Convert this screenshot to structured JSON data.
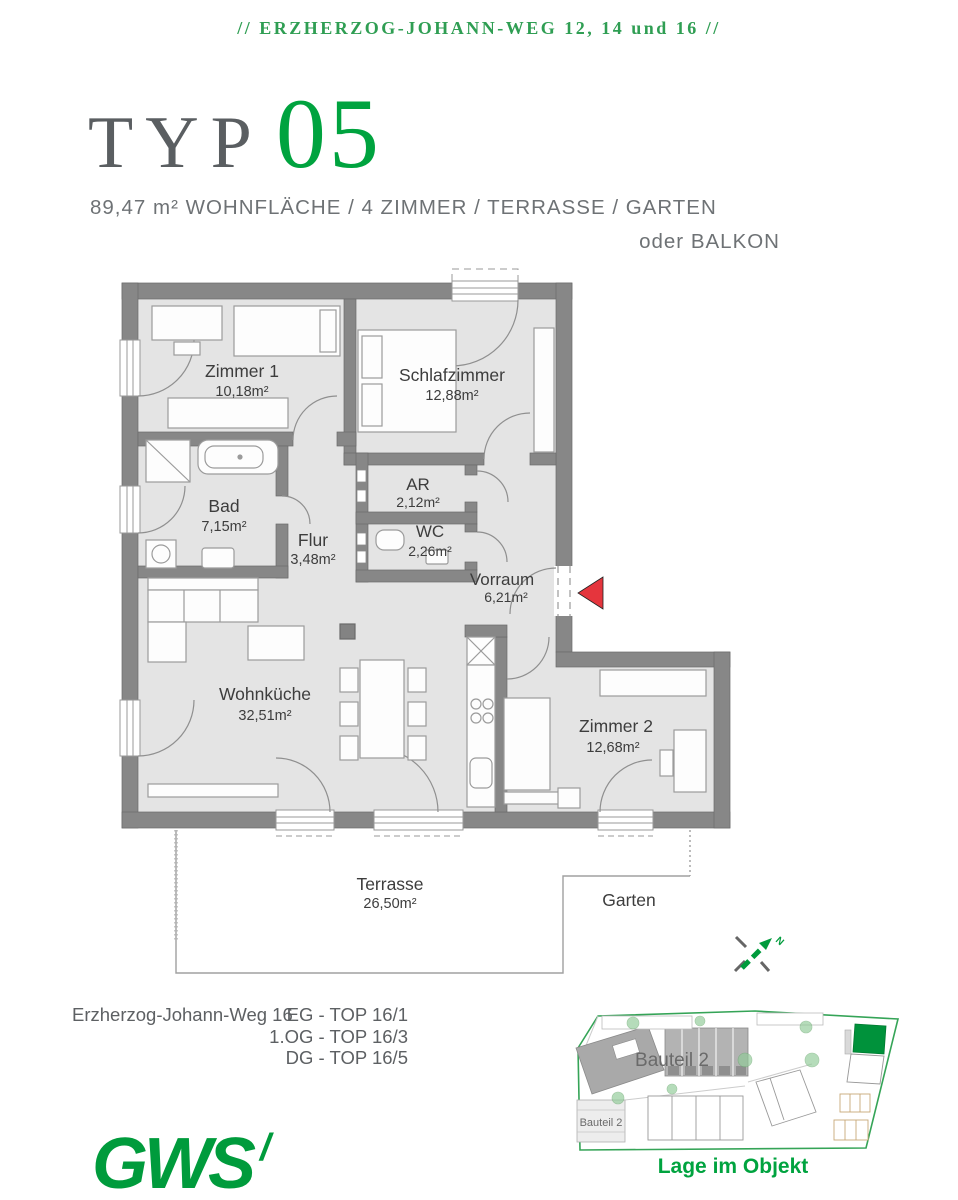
{
  "header": {
    "text": "//  ERZHERZOG-JOHANN-WEG 12, 14 und 16  //"
  },
  "title": {
    "prefix": "TYP",
    "number": "05"
  },
  "subtitle": {
    "line1": "89,47 m² WOHNFLÄCHE  /  4 ZIMMER  /  TERRASSE  /  GARTEN",
    "line2": "oder BALKON"
  },
  "floorplan": {
    "rooms": {
      "zimmer1": {
        "name": "Zimmer 1",
        "area": "10,18m²"
      },
      "schlafzimmer": {
        "name": "Schlafzimmer",
        "area": "12,88m²"
      },
      "bad": {
        "name": "Bad",
        "area": "7,15m²"
      },
      "flur": {
        "name": "Flur",
        "area": "3,48m²"
      },
      "ar": {
        "name": "AR",
        "area": "2,12m²"
      },
      "wc": {
        "name": "WC",
        "area": "2,26m²"
      },
      "vorraum": {
        "name": "Vorraum",
        "area": "6,21m²"
      },
      "wohnkueche": {
        "name": "Wohnküche",
        "area": "32,51m²"
      },
      "zimmer2": {
        "name": "Zimmer 2",
        "area": "12,68m²"
      }
    },
    "outdoor": {
      "terrasse": {
        "name": "Terrasse",
        "area": "26,50m²"
      },
      "garten": {
        "name": "Garten"
      }
    },
    "compass": {
      "label": "N"
    }
  },
  "footer": {
    "address": "Erzherzog-Johann-Weg 16",
    "units": [
      "EG - TOP 16/1",
      "1.OG - TOP 16/3",
      "DG - TOP 16/5"
    ]
  },
  "siteplan": {
    "label_large": "Bauteil 2",
    "label_small": "Bauteil 2",
    "caption": "Lage im Objekt"
  },
  "logo": {
    "text": "GWS",
    "mark": "/"
  },
  "colors": {
    "accent_green": "#009b3c",
    "header_green": "#2f9e53",
    "number_green": "#00a33f",
    "wall_gray": "#878787",
    "room_fill": "#e4e4e4",
    "text_gray": "#6e7275",
    "entrance_red": "#e5353d"
  }
}
